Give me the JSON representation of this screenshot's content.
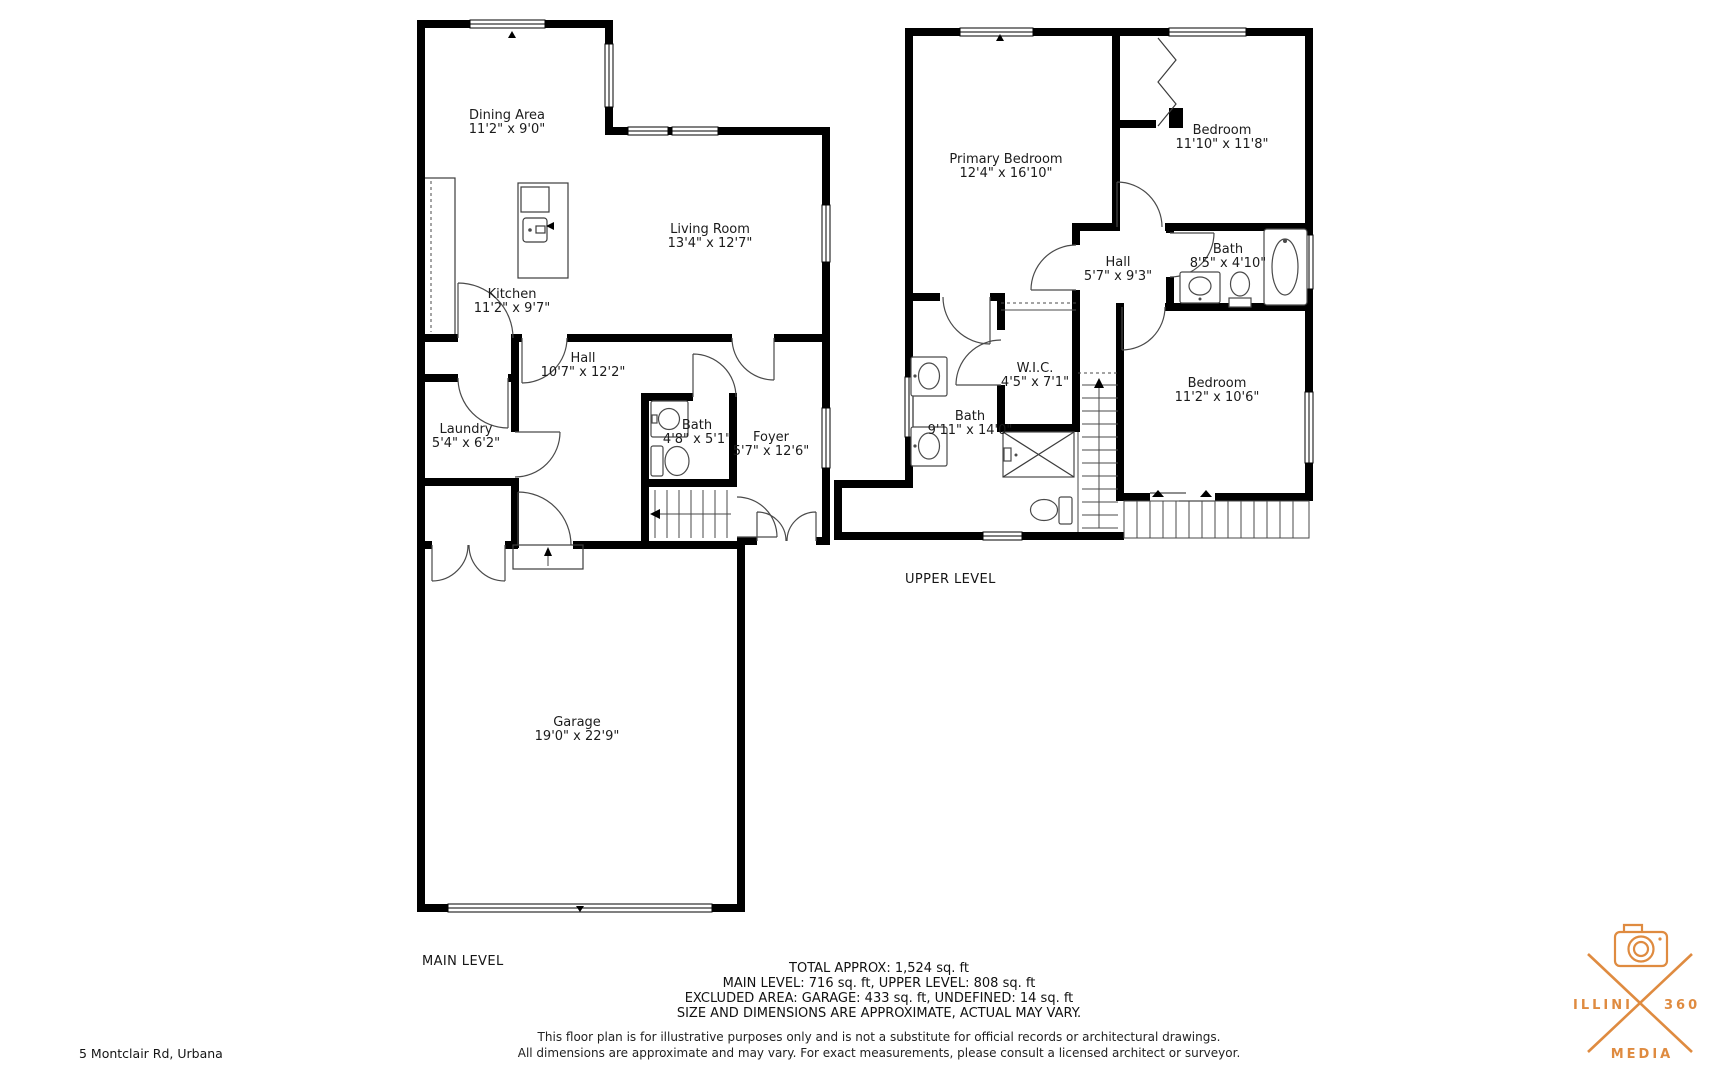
{
  "address": "5 Montclair Rd, Urbana",
  "colors": {
    "wall": "#000000",
    "line": "#4a4a4a",
    "text": "#1b1b1b",
    "logo_orange": "#df8b40"
  },
  "levels": {
    "main": {
      "label": "MAIN LEVEL",
      "rooms": [
        {
          "name": "Dining Area",
          "dims": "11'2\" x 9'0\""
        },
        {
          "name": "Living Room",
          "dims": "13'4\" x 12'7\""
        },
        {
          "name": "Kitchen",
          "dims": "11'2\" x 9'7\""
        },
        {
          "name": "Hall",
          "dims": "10'7\" x 12'2\""
        },
        {
          "name": "Laundry",
          "dims": "5'4\" x 6'2\""
        },
        {
          "name": "Bath",
          "dims": "4'8\" x 5'1\""
        },
        {
          "name": "Foyer",
          "dims": "5'7\" x 12'6\""
        },
        {
          "name": "Garage",
          "dims": "19'0\" x 22'9\""
        }
      ]
    },
    "upper": {
      "label": "UPPER LEVEL",
      "rooms": [
        {
          "name": "Primary Bedroom",
          "dims": "12'4\" x 16'10\""
        },
        {
          "name": "Bedroom",
          "dims": "11'10\" x 11'8\""
        },
        {
          "name": "Hall",
          "dims": "5'7\" x 9'3\""
        },
        {
          "name": "Bath",
          "dims": "8'5\" x 4'10\""
        },
        {
          "name": "W.I.C.",
          "dims": "4'5\" x 7'1\""
        },
        {
          "name": "Bath",
          "dims": "9'11\" x 14'0\""
        },
        {
          "name": "Bedroom",
          "dims": "11'2\" x 10'6\""
        }
      ]
    }
  },
  "summary": {
    "line1": "TOTAL APPROX: 1,524 sq. ft",
    "line2": "MAIN LEVEL: 716 sq. ft, UPPER LEVEL: 808 sq. ft",
    "line3": "EXCLUDED AREA: GARAGE: 433 sq. ft, UNDEFINED: 14 sq. ft",
    "line4": "SIZE AND DIMENSIONS ARE APPROXIMATE, ACTUAL MAY VARY."
  },
  "disclaimer": {
    "line1": "This floor plan is for illustrative purposes only and is not a substitute for official records or architectural drawings.",
    "line2": "All dimensions are approximate and may vary. For exact measurements, please consult a licensed architect or surveyor."
  },
  "logo": {
    "word_left": "ILLINI",
    "word_right": "360",
    "word_bottom": "MEDIA"
  }
}
